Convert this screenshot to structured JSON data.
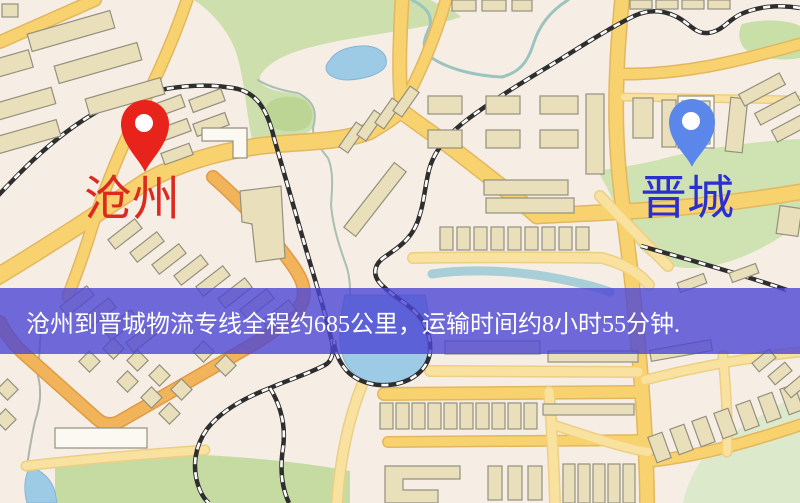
{
  "banner": {
    "text": "沧州到晋城物流专线全程约685公里，运输时间约8小时55分钟.",
    "bg": "rgba(76,70,212,0.80)",
    "text_color": "#ffffff",
    "top": 288,
    "height": 66,
    "padding_left": 26,
    "font_size": 24
  },
  "markers": {
    "origin": {
      "label": "沧州",
      "label_color": "#dc2a1e",
      "pin_color": "#e8231c",
      "tip_x": 145,
      "tip_y": 172,
      "head_y": 124,
      "r": 24,
      "hole_r": 9,
      "label_x": 84,
      "label_y": 176,
      "font": 48
    },
    "destination": {
      "label": "晋城",
      "label_color": "#2b2fd0",
      "pin_color": "#5b87ea",
      "tip_x": 692,
      "tip_y": 167,
      "head_y": 122,
      "r": 23,
      "hole_r": 9,
      "label_x": 640,
      "label_y": 176,
      "font": 47
    }
  },
  "map": {
    "bg": "#f6eee4",
    "palette": {
      "road_fill": "#f7d26e",
      "road_casing": "#e3b75f",
      "minor_fill": "#f9e1a0",
      "minor_casing": "#eccf85",
      "orange_fill": "#f2b45a",
      "orange_casing": "#e09a42",
      "building_fill": "#eadfbb",
      "building_stroke": "#94907f",
      "building_white": "#fcf9f2",
      "rail_dark": "#2e2e2e",
      "rail_light": "#ffffff",
      "water": "#9dcae5",
      "water_stroke": "#84b5d6"
    },
    "greens": [
      {
        "d": "M194,0 L430,0 C446,7 458,13 461,17 C425,29 372,34 333,42 C299,49 270,58 260,76 C258,87 272,91 296,94 C313,101 318,110 312,129 C301,140 276,143 253,144 C247,120 245,80 236,52 C228,30 212,12 194,0 Z",
        "fill": "#ccdfad"
      },
      {
        "d": "M268,104 C274,96 295,94 305,101 C315,108 314,122 306,128 C294,134 276,132 269,124 C264,117 264,110 268,104 Z",
        "fill": "#bcd494"
      },
      {
        "d": "M742,24 C765,18 788,20 800,26 L800,58 C780,62 755,58 744,48 C738,40 738,31 742,24 Z",
        "fill": "#c8dfa8"
      },
      {
        "d": "M598,172 C610,190 618,215 635,242 C648,260 668,269 695,268 C730,266 765,249 800,224 L800,139 C742,142 690,151 658,160 C630,167 605,168 598,172 Z",
        "fill": "#cfe2b2"
      },
      {
        "d": "M800,392 C755,420 715,440 700,462 C690,478 685,492 683,503 L800,503 Z",
        "fill": "#dce9cb"
      },
      {
        "d": "M55,468 C95,457 150,452 205,455 C260,458 315,464 350,471 L350,503 L55,503 Z",
        "fill": "#c6dba2"
      }
    ],
    "waters": [
      {
        "d": "M330,60 C336,50 352,45 368,46 C382,48 388,56 386,65 C382,74 366,79 348,80 C334,80 326,74 326,68 C326,65 328,62 330,60 Z"
      },
      {
        "d": "M345,295 C339,320 337,345 345,362 C353,377 368,384 385,385 C404,386 419,377 426,361 C432,344 430,315 425,295 Z"
      },
      {
        "d": "M30,467 C42,470 52,480 55,492 L57,503 L27,503 C23,488 25,475 30,467 Z"
      }
    ],
    "rivers": [
      {
        "d": "M432,274 C470,268 520,271 560,279 C585,284 600,288 610,292",
        "w": 9,
        "stroke": "#a8cfd8"
      },
      {
        "d": "M258,80 C270,88 290,92 298,93 C313,101 318,110 313,128 C313,140 320,148 328,158 C334,172 332,190 331,205 C333,228 340,248 347,268 C350,278 350,287 350,294",
        "w": 2,
        "stroke": "#a9bfb2"
      },
      {
        "d": "M412,0 C428,8 432,16 430,26 C424,40 420,48 432,58 C450,70 478,76 502,77 C520,72 528,62 534,42 C540,24 552,10 568,0",
        "w": 3,
        "stroke": "#9cc4be"
      },
      {
        "d": "M42,318 C40,340 39,358 38,376 C42,392 40,406 35,421 C31,440 29,452 28,460",
        "w": 2,
        "stroke": "#adb5ad"
      }
    ],
    "roads": [
      {
        "d": "M0,42 L95,0",
        "w": 11,
        "t": "major"
      },
      {
        "d": "M187,0 C170,50 150,90 135,120 C118,155 100,200 88,240 C80,265 74,280 68,296",
        "w": 10,
        "t": "major"
      },
      {
        "d": "M402,112 C398,75 400,38 402,0",
        "w": 12,
        "t": "major"
      },
      {
        "d": "M400,110 C418,78 434,42 446,0",
        "w": 10,
        "t": "major"
      },
      {
        "d": "M-5,278 C50,245 100,212 145,182 C175,165 215,152 260,146 C300,141 340,143 370,131 C383,123 393,117 400,110",
        "w": 15,
        "t": "major"
      },
      {
        "d": "M400,110 C415,122 432,133 452,148 C480,170 515,196 537,216 C570,214 600,213 632,211 C688,208 745,201 800,192",
        "w": 14,
        "t": "major"
      },
      {
        "d": "M622,0 C616,60 614,120 619,172 C623,215 629,252 633,292 C637,330 641,372 644,420 C646,455 647,480 647,503",
        "w": 13,
        "t": "major"
      },
      {
        "d": "M620,74 C680,75 732,63 800,44",
        "w": 10,
        "t": "major"
      },
      {
        "d": "M624,97 L800,100",
        "w": 6,
        "t": "minor"
      },
      {
        "d": "M213,177 C243,203 270,234 291,263 C301,277 306,287 303,300 C298,314 278,329 252,345 L122,420 Q108,429 96,418 L22,352 C12,342 4,331 0,322",
        "w": 11,
        "t": "orange"
      },
      {
        "d": "M430,371 L638,372",
        "w": 9,
        "t": "minor"
      },
      {
        "d": "M384,394 L642,392",
        "w": 11,
        "t": "major"
      },
      {
        "d": "M413,258 C480,257 545,257 602,258 C625,264 640,274 649,285",
        "w": 9,
        "t": "minor"
      },
      {
        "d": "M600,196 C625,222 650,248 668,266",
        "w": 9,
        "t": "minor"
      },
      {
        "d": "M388,442 L646,440",
        "w": 9,
        "t": "major"
      },
      {
        "d": "M549,392 C552,430 554,468 555,503",
        "w": 9,
        "t": "minor"
      },
      {
        "d": "M551,424 C592,438 625,448 648,452",
        "w": 8,
        "t": "minor"
      },
      {
        "d": "M645,380 C700,366 752,357 800,352",
        "w": 8,
        "t": "minor"
      },
      {
        "d": "M645,462 C702,456 752,441 800,425",
        "w": 10,
        "t": "major"
      },
      {
        "d": "M723,355 C726,390 728,420 727,452",
        "w": 8,
        "t": "minor"
      },
      {
        "d": "M26,466 C85,459 148,454 205,450",
        "w": 8,
        "t": "minor"
      },
      {
        "d": "M362,385 C348,420 340,460 337,503",
        "w": 9,
        "t": "minor"
      }
    ],
    "railways": [
      {
        "d": "M-6,200 C20,172 55,135 100,110 C140,90 195,80 238,89 C258,94 268,112 274,138 C282,165 291,198 301,232 C309,260 319,292 326,318 L332,342 C334,353 332,361 325,365 C308,374 288,380 270,388 C244,398 221,411 207,429 C195,446 192,466 198,485 C201,494 205,500 209,503"
      },
      {
        "d": "M270,388 C281,406 286,426 283,448 C280,468 281,486 289,503"
      },
      {
        "d": "M800,8 C778,4 757,7 741,14 C728,20 723,31 708,33 C694,34 689,22 675,16 C660,9 646,10 632,17 C610,28 588,42 564,57 C530,78 497,97 468,119 C448,134 434,151 429,170 C425,186 424,202 420,214 C414,238 399,247 386,256 C375,263 372,273 379,282 C390,295 408,303 418,315 C428,327 431,340 430,352 C428,368 415,380 396,384 C374,388 353,381 343,366 C337,357 334,348 334,340"
      },
      {
        "d": "M641,246 C690,260 740,274 787,290"
      }
    ],
    "buildings": [
      [
        28,
        22,
        86,
        18,
        -16,
        0
      ],
      [
        55,
        54,
        86,
        18,
        -16,
        0
      ],
      [
        -30,
        58,
        62,
        18,
        -16,
        0
      ],
      [
        -25,
        98,
        80,
        17,
        -16,
        0
      ],
      [
        -18,
        130,
        78,
        17,
        -16,
        0
      ],
      [
        86,
        88,
        78,
        17,
        -16,
        0
      ],
      [
        2,
        4,
        16,
        13,
        0,
        0
      ],
      [
        150,
        100,
        34,
        13,
        -20,
        0
      ],
      [
        190,
        94,
        34,
        13,
        -20,
        0
      ],
      [
        156,
        124,
        34,
        13,
        -20,
        0
      ],
      [
        194,
        118,
        34,
        13,
        -20,
        0
      ],
      [
        162,
        148,
        30,
        12,
        -20,
        0
      ],
      [
        108,
        228,
        34,
        12,
        -38,
        0
      ],
      [
        130,
        241,
        34,
        12,
        -38,
        0
      ],
      [
        152,
        253,
        34,
        12,
        -38,
        0
      ],
      [
        174,
        264,
        34,
        12,
        -38,
        0
      ],
      [
        196,
        275,
        34,
        12,
        -38,
        0
      ],
      [
        218,
        287,
        34,
        12,
        -38,
        0
      ],
      [
        240,
        298,
        34,
        12,
        -38,
        0
      ],
      [
        262,
        309,
        34,
        12,
        -38,
        0
      ],
      [
        60,
        295,
        34,
        12,
        -38,
        0
      ],
      [
        82,
        307,
        34,
        12,
        -38,
        0
      ],
      [
        104,
        319,
        34,
        12,
        -38,
        0
      ],
      [
        126,
        331,
        34,
        12,
        -38,
        0
      ],
      [
        337,
        132,
        30,
        11,
        -55,
        0
      ],
      [
        355,
        120,
        30,
        11,
        -55,
        0
      ],
      [
        373,
        108,
        30,
        11,
        -55,
        0
      ],
      [
        391,
        96,
        30,
        11,
        -55,
        0
      ],
      [
        334,
        192,
        82,
        15,
        -52,
        0
      ],
      [
        428,
        96,
        34,
        18,
        0,
        0
      ],
      [
        428,
        130,
        34,
        18,
        0,
        0
      ],
      [
        486,
        96,
        34,
        18,
        0,
        0
      ],
      [
        486,
        130,
        34,
        18,
        0,
        0
      ],
      [
        540,
        96,
        38,
        18,
        0,
        0
      ],
      [
        540,
        130,
        38,
        18,
        0,
        0
      ],
      [
        586,
        94,
        18,
        80,
        0,
        0
      ],
      [
        484,
        180,
        84,
        15,
        0,
        0
      ],
      [
        486,
        198,
        88,
        15,
        0,
        0
      ],
      [
        440,
        227,
        13,
        23,
        0,
        0
      ],
      [
        457,
        227,
        13,
        23,
        0,
        0
      ],
      [
        474,
        227,
        13,
        23,
        0,
        0
      ],
      [
        491,
        227,
        13,
        23,
        0,
        0
      ],
      [
        508,
        227,
        13,
        23,
        0,
        0
      ],
      [
        525,
        227,
        13,
        23,
        0,
        0
      ],
      [
        542,
        227,
        13,
        23,
        0,
        0
      ],
      [
        559,
        227,
        13,
        23,
        0,
        0
      ],
      [
        576,
        227,
        13,
        23,
        0,
        0
      ],
      [
        633,
        98,
        20,
        40,
        0,
        0
      ],
      [
        662,
        100,
        14,
        47,
        0,
        0
      ],
      [
        678,
        96,
        36,
        52,
        0,
        1
      ],
      [
        682,
        101,
        28,
        13,
        0,
        0
      ],
      [
        682,
        120,
        28,
        24,
        0,
        0
      ],
      [
        728,
        98,
        17,
        54,
        6,
        0
      ],
      [
        630,
        0,
        22,
        9,
        0,
        0
      ],
      [
        656,
        0,
        22,
        9,
        0,
        0
      ],
      [
        682,
        0,
        22,
        9,
        0,
        0
      ],
      [
        708,
        0,
        22,
        9,
        0,
        0
      ],
      [
        452,
        0,
        24,
        11,
        0,
        0
      ],
      [
        482,
        0,
        24,
        11,
        0,
        0
      ],
      [
        512,
        0,
        20,
        11,
        0,
        0
      ],
      [
        739,
        83,
        46,
        13,
        -28,
        0
      ],
      [
        755,
        102,
        46,
        13,
        -28,
        0
      ],
      [
        772,
        120,
        42,
        13,
        -28,
        0
      ],
      [
        778,
        207,
        22,
        28,
        8,
        0
      ],
      [
        678,
        278,
        28,
        10,
        -20,
        0
      ],
      [
        730,
        268,
        28,
        10,
        -20,
        0
      ],
      [
        445,
        341,
        95,
        13,
        0,
        0
      ],
      [
        548,
        351,
        90,
        11,
        0,
        0
      ],
      [
        650,
        345,
        62,
        11,
        -10,
        0
      ],
      [
        380,
        403,
        13,
        26,
        0,
        0
      ],
      [
        396,
        403,
        13,
        26,
        0,
        0
      ],
      [
        412,
        403,
        13,
        26,
        0,
        0
      ],
      [
        428,
        403,
        13,
        26,
        0,
        0
      ],
      [
        444,
        403,
        13,
        26,
        0,
        0
      ],
      [
        460,
        403,
        13,
        26,
        0,
        0
      ],
      [
        476,
        403,
        13,
        26,
        0,
        0
      ],
      [
        492,
        403,
        13,
        26,
        0,
        0
      ],
      [
        508,
        403,
        13,
        26,
        0,
        0
      ],
      [
        524,
        403,
        13,
        26,
        0,
        0
      ],
      [
        543,
        404,
        91,
        11,
        0,
        0
      ],
      [
        488,
        466,
        14,
        34,
        0,
        0
      ],
      [
        508,
        466,
        14,
        34,
        0,
        0
      ],
      [
        528,
        466,
        14,
        34,
        0,
        0
      ],
      [
        563,
        464,
        12,
        39,
        0,
        0
      ],
      [
        578,
        464,
        12,
        39,
        0,
        0
      ],
      [
        593,
        464,
        12,
        39,
        0,
        0
      ],
      [
        608,
        464,
        12,
        39,
        0,
        0
      ],
      [
        623,
        464,
        12,
        39,
        0,
        0
      ],
      [
        652,
        434,
        15,
        27,
        -20,
        0
      ],
      [
        674,
        426,
        15,
        27,
        -20,
        0
      ],
      [
        696,
        418,
        15,
        27,
        -20,
        0
      ],
      [
        718,
        410,
        15,
        27,
        -20,
        0
      ],
      [
        740,
        402,
        15,
        27,
        -20,
        0
      ],
      [
        762,
        394,
        15,
        27,
        -20,
        0
      ],
      [
        784,
        386,
        15,
        27,
        -20,
        0
      ],
      [
        753,
        355,
        22,
        11,
        -40,
        0
      ],
      [
        769,
        368,
        22,
        11,
        -40,
        0
      ],
      [
        785,
        381,
        22,
        11,
        -40,
        0
      ],
      [
        55,
        428,
        92,
        20,
        0,
        1
      ],
      [
        82,
        354,
        15,
        15,
        45,
        0
      ],
      [
        106,
        341,
        15,
        15,
        45,
        0
      ],
      [
        130,
        353,
        15,
        15,
        45,
        0
      ],
      [
        152,
        368,
        15,
        15,
        45,
        0
      ],
      [
        174,
        382,
        15,
        15,
        45,
        0
      ],
      [
        144,
        390,
        15,
        15,
        45,
        0
      ],
      [
        162,
        406,
        15,
        15,
        45,
        0
      ],
      [
        120,
        374,
        15,
        15,
        45,
        0
      ],
      [
        0,
        382,
        15,
        15,
        45,
        0
      ],
      [
        -2,
        412,
        15,
        15,
        45,
        0
      ],
      [
        196,
        344,
        15,
        15,
        45,
        0
      ],
      [
        218,
        358,
        15,
        15,
        45,
        0
      ]
    ],
    "building_paths": [
      {
        "d": "M202,128 L247,128 L247,158 L233,158 L233,141 L202,141 Z",
        "white": 1
      },
      {
        "d": "M240,191 L281,186 L285,258 L256,262 L252,224 L242,222 Z",
        "white": 0
      },
      {
        "d": "M385,466 L460,466 L460,479 L403,479 L403,490 L438,490 L438,503 L385,503 Z",
        "white": 0
      }
    ]
  }
}
